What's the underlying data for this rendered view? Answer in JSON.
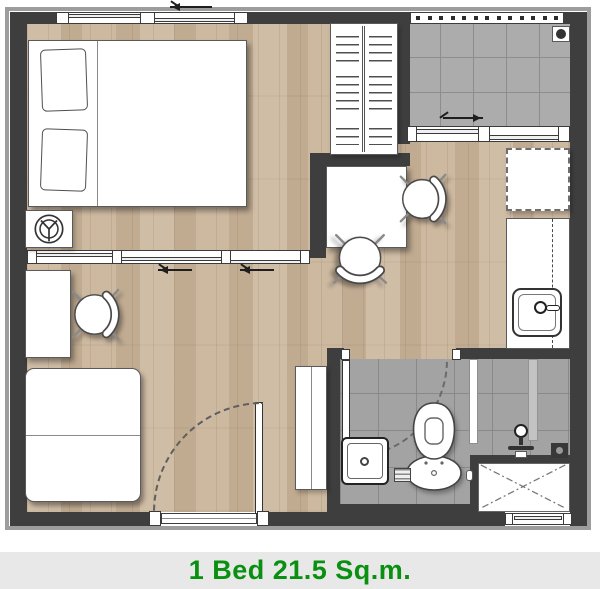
{
  "caption": {
    "text": "1 Bed 21.5 Sq.m."
  },
  "colors": {
    "accent": "#0a9010",
    "capbg": "#e8e8e8",
    "wall": "#3e3e3e",
    "wood": "#cbb69c",
    "tilebalcony": "#acacac",
    "tilebath": "#a3a3a3",
    "furniture": "#ffffff"
  },
  "legend": {
    "items": [
      {
        "name": "double-bed-with-pillows"
      },
      {
        "name": "bedside-stool"
      },
      {
        "name": "wardrobe-with-hangers"
      },
      {
        "name": "balcony-tiled-with-drain"
      },
      {
        "name": "dining-table-with-two-chairs"
      },
      {
        "name": "desk-with-chair"
      },
      {
        "name": "two-seat-sofa"
      },
      {
        "name": "refrigerator-dashed"
      },
      {
        "name": "kitchen-counter-with-sink"
      },
      {
        "name": "tall-cabinet"
      },
      {
        "name": "bathroom-toilet"
      },
      {
        "name": "bathroom-wash-basin"
      },
      {
        "name": "shower-with-glass-partition-and-drain"
      },
      {
        "name": "service-shaft"
      },
      {
        "name": "entrance-swing-door"
      },
      {
        "name": "sliding-partition-door"
      },
      {
        "name": "sliding-windows"
      }
    ]
  }
}
